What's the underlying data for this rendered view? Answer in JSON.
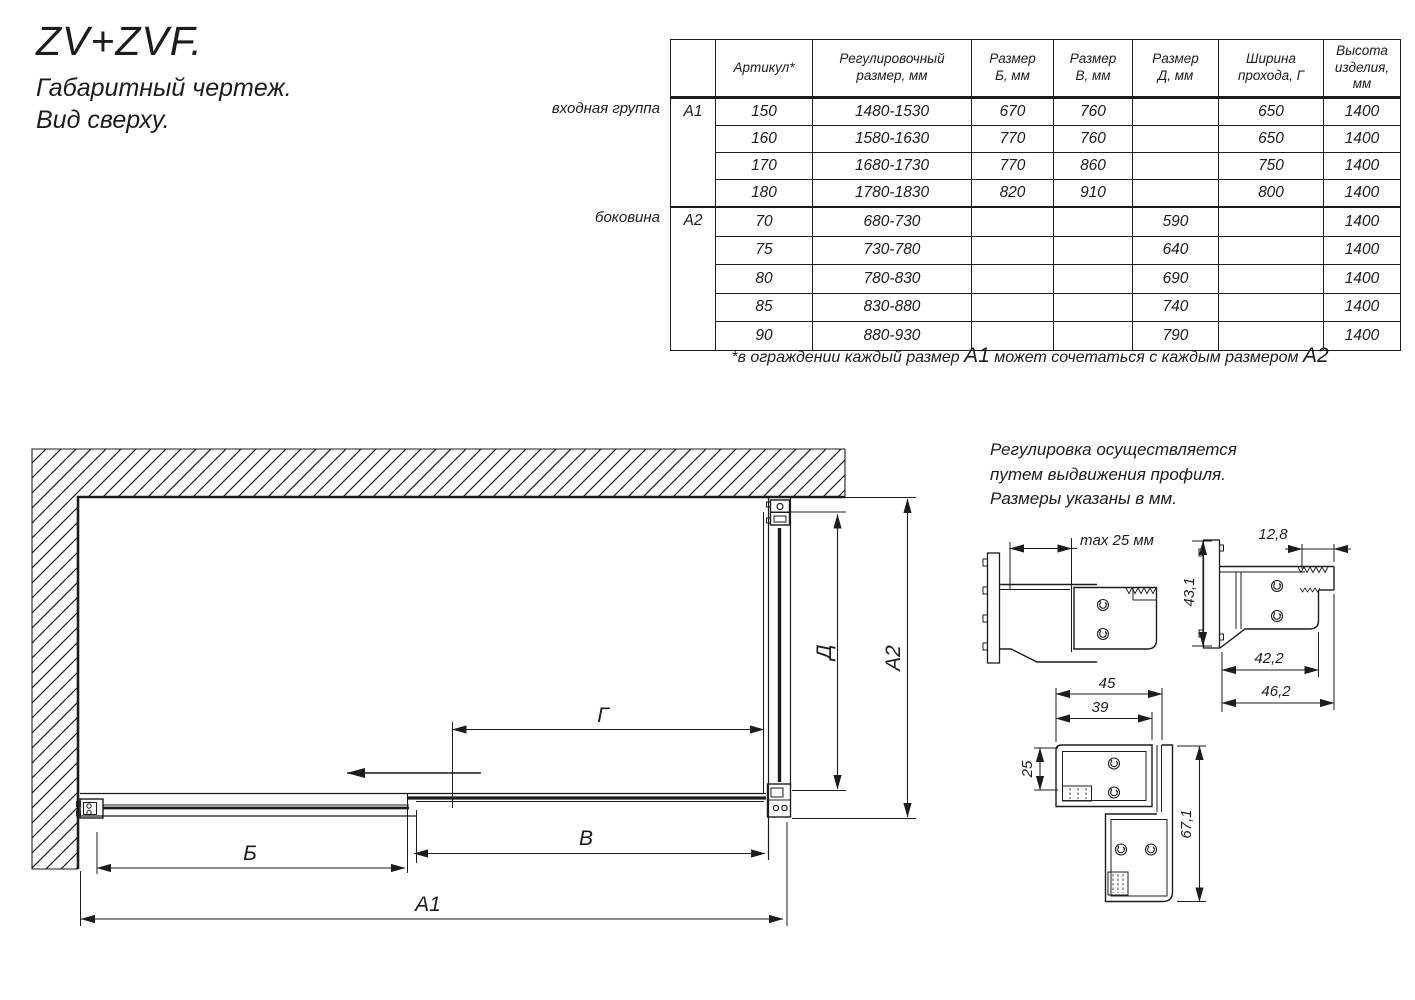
{
  "title": {
    "product": "ZV+ZVF.",
    "subtitle1": "Габаритный чертеж.",
    "subtitle2": "Вид сверху."
  },
  "table": {
    "headers": [
      "Артикул*",
      "Регулировочный\nразмер, мм",
      "Размер\nБ, мм",
      "Размер\nВ, мм",
      "Размер\nД, мм",
      "Ширина\nпрохода, Г",
      "Высота\nизделия,\nмм"
    ],
    "group1": {
      "side_label": "входная группа",
      "code": "А1",
      "rows": [
        [
          "150",
          "1480-1530",
          "670",
          "760",
          "",
          "650",
          "1400"
        ],
        [
          "160",
          "1580-1630",
          "770",
          "760",
          "",
          "650",
          "1400"
        ],
        [
          "170",
          "1680-1730",
          "770",
          "860",
          "",
          "750",
          "1400"
        ],
        [
          "180",
          "1780-1830",
          "820",
          "910",
          "",
          "800",
          "1400"
        ]
      ]
    },
    "group2": {
      "side_label": "боковина",
      "code": "А2",
      "rows": [
        [
          "70",
          "680-730",
          "",
          "",
          "590",
          "",
          "1400"
        ],
        [
          "75",
          "730-780",
          "",
          "",
          "640",
          "",
          "1400"
        ],
        [
          "80",
          "780-830",
          "",
          "",
          "690",
          "",
          "1400"
        ],
        [
          "85",
          "830-880",
          "",
          "",
          "740",
          "",
          "1400"
        ],
        [
          "90",
          "880-930",
          "",
          "",
          "790",
          "",
          "1400"
        ]
      ]
    }
  },
  "footnote": {
    "p1": "*в ограждении каждый размер ",
    "a1": "А1",
    "p2": " может сочетаться с каждым размером ",
    "a2": "А2"
  },
  "note": {
    "l1": "Регулировка осуществляется",
    "l2": "путем выдвижения профиля.",
    "l3": "Размеры указаны в мм."
  },
  "dims": {
    "b": "Б",
    "v": "В",
    "g": "Г",
    "d": "Д",
    "a1": "А1",
    "a2": "А2"
  },
  "details": {
    "max25": "max 25 мм",
    "d128": "12,8",
    "d431": "43,1",
    "d422": "42,2",
    "d462": "46,2",
    "d45": "45",
    "d39": "39",
    "d25": "25",
    "d671": "67,1"
  },
  "colors": {
    "ink": "#1c1c1c",
    "bg": "#ffffff"
  }
}
